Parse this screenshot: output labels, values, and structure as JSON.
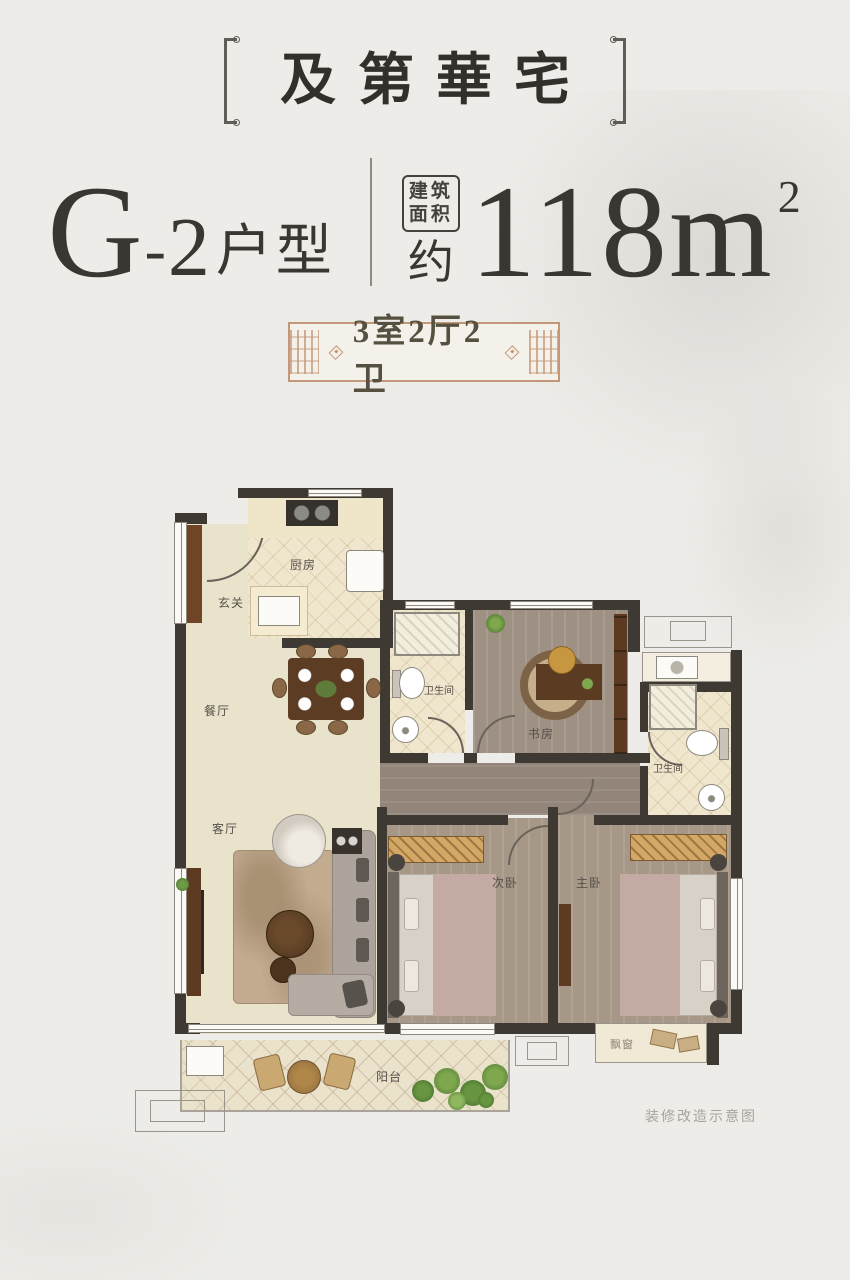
{
  "header": {
    "title": "及第華宅",
    "unit_main": "G",
    "unit_dash": "-",
    "unit_num": "2",
    "unit_suffix": "户型",
    "area_stamp_top": "建筑",
    "area_stamp_bottom": "面积",
    "area_approx": "约",
    "area_value": "118m",
    "area_exponent": "2",
    "badge_label": "3室2厅2卫"
  },
  "plan": {
    "caption": "装修改造示意图",
    "rooms": {
      "entry": "玄关",
      "kitchen": "厨房",
      "dining": "餐厅",
      "living": "客厅",
      "bath1": "卫生间",
      "study": "书房",
      "bath2": "卫生间",
      "bedroom2": "次卧",
      "master": "主卧",
      "balcony": "阳台",
      "bay_window": "飘窗"
    }
  },
  "colors": {
    "background": "#EDECE8",
    "ink": "#34312D",
    "badge_border": "#C39878",
    "badge_text": "#55503F",
    "wall": "#3E3933",
    "floor_cream": "#EAE3CC",
    "floor_wood": "#A69786",
    "caption": "#A8A49D"
  }
}
